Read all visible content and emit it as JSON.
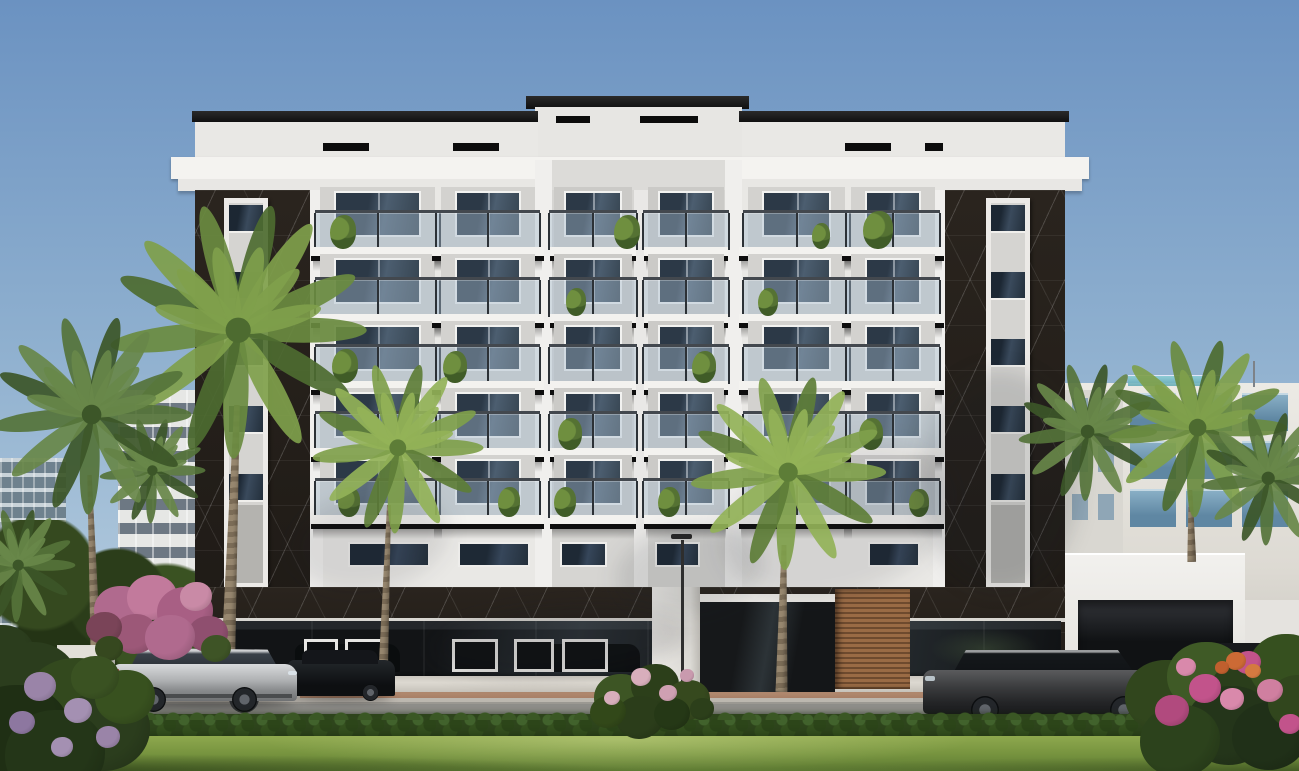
{
  "scene": {
    "type": "architectural-exterior-render",
    "subject": "Modern seven-storey residential apartment building, white facade with black marble corner pilasters, glass balconies with plants, dark glass storefront podium, landscaped street with palm trees, hedges, lawn and parked cars",
    "time_of_day": "daytime",
    "weather": "clear blue sky"
  },
  "palette": {
    "sky-top": "#6b92c1",
    "sky-horizon": "#aac4da",
    "facade-white": "#e9e8e5",
    "cornice-white": "#f4f3f0",
    "tower-grey": "#dcdbd8",
    "marble-black": "#241f1a",
    "window-glass": "#2e3b4c",
    "balcony-soffit": "#0e0e0e",
    "storefront-glass": "#17191b",
    "wood-slats": "#8a5f3d",
    "road": "#8e8d89",
    "sidewalk": "#bcb7af",
    "hedge-green": "#2e451c",
    "lawn-green": "#77943f",
    "palm-green": "#5d7d37",
    "bougainvillea-pink": "#b06a8e"
  },
  "building": {
    "storeys_total": 7,
    "balcony_floor_count": 5,
    "balcony_rows_y": [
      247,
      314,
      381,
      448,
      515
    ],
    "bays": [
      {
        "id": "A",
        "x": 322,
        "w": 111,
        "tower": false
      },
      {
        "id": "B",
        "x": 443,
        "w": 90,
        "tower": false
      },
      {
        "id": "C",
        "x": 750,
        "w": 93,
        "tower": false
      },
      {
        "id": "D",
        "x": 853,
        "w": 80,
        "tower": false
      },
      {
        "id": "TL",
        "x": 556,
        "w": 74,
        "tower": true
      },
      {
        "id": "TR",
        "x": 650,
        "w": 72,
        "tower": true
      }
    ],
    "parapet_vents": [
      [
        323,
        46
      ],
      [
        453,
        46
      ],
      [
        845,
        46
      ],
      [
        925,
        18
      ]
    ],
    "tower_vents": [
      [
        556,
        34
      ],
      [
        640,
        58
      ]
    ],
    "pilaster_strips": [
      {
        "x": 224,
        "w": 44
      },
      {
        "x": 986,
        "w": 44
      }
    ],
    "strip_pane_ys": [
      205,
      272,
      339,
      406,
      474
    ],
    "mezzanine_windows": [
      [
        348,
        82
      ],
      [
        458,
        72
      ],
      [
        560,
        47
      ],
      [
        655,
        45
      ],
      [
        868,
        52
      ]
    ],
    "storefront_panels": [
      [
        304,
        34
      ],
      [
        345,
        42
      ],
      [
        452,
        46
      ],
      [
        514,
        40
      ],
      [
        562,
        46
      ]
    ],
    "balcony_plants": [
      {
        "bay": 0,
        "row": 1,
        "dx": 8,
        "s": 26
      },
      {
        "bay": 4,
        "row": 1,
        "dx": 58,
        "s": 26
      },
      {
        "bay": 3,
        "row": 1,
        "dx": 10,
        "s": 30
      },
      {
        "bay": 2,
        "row": 1,
        "dx": 62,
        "s": 18
      },
      {
        "bay": 2,
        "row": 2,
        "dx": 8,
        "s": 20
      },
      {
        "bay": 4,
        "row": 2,
        "dx": 10,
        "s": 20
      },
      {
        "bay": 0,
        "row": 3,
        "dx": 10,
        "s": 26
      },
      {
        "bay": 1,
        "row": 3,
        "dx": 0,
        "s": 24
      },
      {
        "bay": 5,
        "row": 3,
        "dx": 42,
        "s": 24
      },
      {
        "bay": 4,
        "row": 4,
        "dx": 2,
        "s": 24
      },
      {
        "bay": 3,
        "row": 4,
        "dx": 6,
        "s": 24
      },
      {
        "bay": 0,
        "row": 5,
        "dx": 16,
        "s": 22
      },
      {
        "bay": 1,
        "row": 5,
        "dx": 55,
        "s": 22
      },
      {
        "bay": 4,
        "row": 5,
        "dx": -2,
        "s": 22
      },
      {
        "bay": 5,
        "row": 5,
        "dx": 8,
        "s": 22
      },
      {
        "bay": 3,
        "row": 5,
        "dx": 56,
        "s": 20
      }
    ],
    "glass_reflection_cars": [
      [
        295,
        105
      ],
      [
        520,
        120
      ]
    ]
  },
  "street": {
    "lamp": {
      "x": 681,
      "y": 540,
      "h": 150
    },
    "has_sidewalk": true,
    "has_terracotta_pavers": true,
    "has_hedge": true,
    "has_lawn": true
  },
  "vehicles": [
    {
      "kind": "silver-suv",
      "x": 113,
      "y": 648,
      "w": 185,
      "facing": "right"
    },
    {
      "kind": "dark-sedan",
      "x": 288,
      "y": 652,
      "w": 107,
      "facing": "right"
    },
    {
      "kind": "graphite-suv",
      "x": 923,
      "y": 646,
      "w": 244,
      "facing": "left"
    },
    {
      "kind": "dark-suv",
      "x": 1172,
      "y": 641,
      "w": 128,
      "facing": "left"
    }
  ],
  "palms": [
    {
      "cx": 152,
      "cy": 470,
      "r": 52,
      "shade": "dark",
      "trunk": null
    },
    {
      "cx": 18,
      "cy": 565,
      "r": 56,
      "shade": "dark",
      "trunk": null
    },
    {
      "cx": 238,
      "cy": 330,
      "r": 126,
      "shade": "mid",
      "trunk": {
        "x": 230,
        "y": 405,
        "w": 14,
        "h": 255,
        "rot": 2
      }
    },
    {
      "cx": 92,
      "cy": 415,
      "r": 98,
      "shade": "dark",
      "trunk": {
        "x": 84,
        "y": 475,
        "w": 11,
        "h": 200,
        "rot": -2
      }
    },
    {
      "cx": 398,
      "cy": 448,
      "r": 84,
      "shade": "light",
      "trunk": {
        "x": 384,
        "y": 505,
        "w": 10,
        "h": 185,
        "rot": 2
      }
    },
    {
      "cx": 788,
      "cy": 472,
      "r": 96,
      "shade": "light",
      "trunk": {
        "x": 778,
        "y": 545,
        "w": 12,
        "h": 147,
        "rot": 1
      }
    },
    {
      "cx": 1088,
      "cy": 432,
      "r": 68,
      "shade": "dark",
      "trunk": null
    },
    {
      "cx": 1198,
      "cy": 428,
      "r": 88,
      "shade": "mid",
      "trunk": {
        "x": 1186,
        "y": 490,
        "w": 9,
        "h": 72,
        "rot": -1
      }
    },
    {
      "cx": 1268,
      "cy": 478,
      "r": 66,
      "shade": "dark",
      "trunk": null
    }
  ],
  "palm_palettes": {
    "light": [
      "#7fa04b",
      "#5d7d37",
      "#93b258"
    ],
    "mid": [
      "#6a8b40",
      "#4d6b30",
      "#7fa04b"
    ],
    "dark": [
      "#55733a",
      "#3c5628",
      "#688749"
    ]
  },
  "bushes": [
    {
      "name": "bougainvillea-left",
      "blobs": [
        [
          120,
          612,
          26,
          "#b06a8e"
        ],
        [
          152,
          600,
          25,
          "#c27a9c"
        ],
        [
          185,
          615,
          28,
          "#a85f84"
        ],
        [
          208,
          636,
          20,
          "#8f4f6f"
        ],
        [
          135,
          636,
          22,
          "#9c5878"
        ],
        [
          170,
          640,
          25,
          "#b06a8e"
        ],
        [
          104,
          630,
          18,
          "#7a4458"
        ],
        [
          196,
          598,
          16,
          "#c98aa6"
        ],
        [
          216,
          650,
          15,
          "#3e5426"
        ],
        [
          109,
          650,
          14,
          "#36481f"
        ]
      ]
    },
    {
      "name": "front-left-bush",
      "blobs": [
        [
          0,
          660,
          35,
          "#2b3d1d"
        ],
        [
          30,
          690,
          48,
          "#2b3d1d"
        ],
        [
          75,
          710,
          52,
          "#33491e"
        ],
        [
          15,
          740,
          55,
          "#1f2f14"
        ],
        [
          105,
          735,
          45,
          "#2b3d1d"
        ],
        [
          55,
          760,
          50,
          "#243618"
        ],
        [
          125,
          700,
          30,
          "#38511f"
        ],
        [
          95,
          680,
          24,
          "#3a5222"
        ],
        [
          40,
          688,
          16,
          "#9a84a8"
        ],
        [
          78,
          712,
          14,
          "#a490b2"
        ],
        [
          108,
          738,
          12,
          "#9a84a8"
        ],
        [
          22,
          724,
          13,
          "#8d77a0"
        ],
        [
          62,
          748,
          11,
          "#a490b2"
        ]
      ]
    },
    {
      "name": "center-shrub",
      "blobs": [
        [
          620,
          700,
          26,
          "#3d5524"
        ],
        [
          655,
          688,
          24,
          "#2c3f1a"
        ],
        [
          688,
          702,
          22,
          "#36491e"
        ],
        [
          640,
          720,
          24,
          "#2b3d1a"
        ],
        [
          608,
          714,
          18,
          "#324819"
        ],
        [
          672,
          716,
          18,
          "#253816"
        ],
        [
          702,
          710,
          12,
          "#2c3f1a"
        ],
        [
          641,
          678,
          10,
          "#d8aebc"
        ],
        [
          668,
          694,
          9,
          "#cfa0b2"
        ],
        [
          612,
          699,
          8,
          "#d8aebc"
        ],
        [
          687,
          676,
          7,
          "#c99aae"
        ]
      ]
    },
    {
      "name": "right-flower-bushes",
      "blobs": [
        [
          1165,
          700,
          40,
          "#31461d"
        ],
        [
          1205,
          680,
          38,
          "#3f5a26"
        ],
        [
          1250,
          700,
          42,
          "#2a3e1b"
        ],
        [
          1285,
          670,
          36,
          "#36501f"
        ],
        [
          1230,
          730,
          44,
          "#24351a"
        ],
        [
          1180,
          745,
          40,
          "#2c421c"
        ],
        [
          1270,
          740,
          38,
          "#203018"
        ],
        [
          1298,
          705,
          30,
          "#31461d"
        ],
        [
          1205,
          690,
          16,
          "#c2538b"
        ],
        [
          1248,
          664,
          13,
          "#c2538b"
        ],
        [
          1172,
          712,
          17,
          "#b14a7e"
        ],
        [
          1232,
          700,
          12,
          "#d989ab"
        ],
        [
          1270,
          692,
          13,
          "#d07fa0"
        ],
        [
          1290,
          725,
          11,
          "#c2538b"
        ],
        [
          1236,
          662,
          10,
          "#cc6a35"
        ],
        [
          1253,
          672,
          8,
          "#d47a40"
        ],
        [
          1222,
          668,
          7,
          "#c05f2e"
        ],
        [
          1186,
          668,
          10,
          "#d989ab"
        ]
      ]
    }
  ],
  "background_buildings": {
    "left_glass_tower": {
      "x": 0,
      "y": 458,
      "w": 66,
      "h": 212
    },
    "left_white_tower": {
      "x": 118,
      "y": 390,
      "w": 104,
      "h": 272
    },
    "right_modern_block": {
      "x": 1063,
      "y": 383,
      "w": 236,
      "h": 262,
      "window_cols_x": [
        1130,
        1186,
        1242
      ],
      "window_col_w": 46,
      "window_rows_y": [
        393,
        441,
        489
      ],
      "window_row_h": 38,
      "side_window_cols_x": [
        1072,
        1098
      ],
      "side_window_rows_y": [
        398,
        446,
        494
      ]
    }
  },
  "facade_shadow_blobs": [
    [
      838,
      520,
      240,
      150,
      -18,
      0.1
    ],
    [
      690,
      570,
      150,
      90,
      -10,
      0.12
    ],
    [
      1000,
      480,
      160,
      220,
      0,
      0.14
    ],
    [
      370,
      540,
      160,
      100,
      -12,
      0.1
    ],
    [
      560,
      640,
      260,
      70,
      -4,
      0.16
    ]
  ]
}
